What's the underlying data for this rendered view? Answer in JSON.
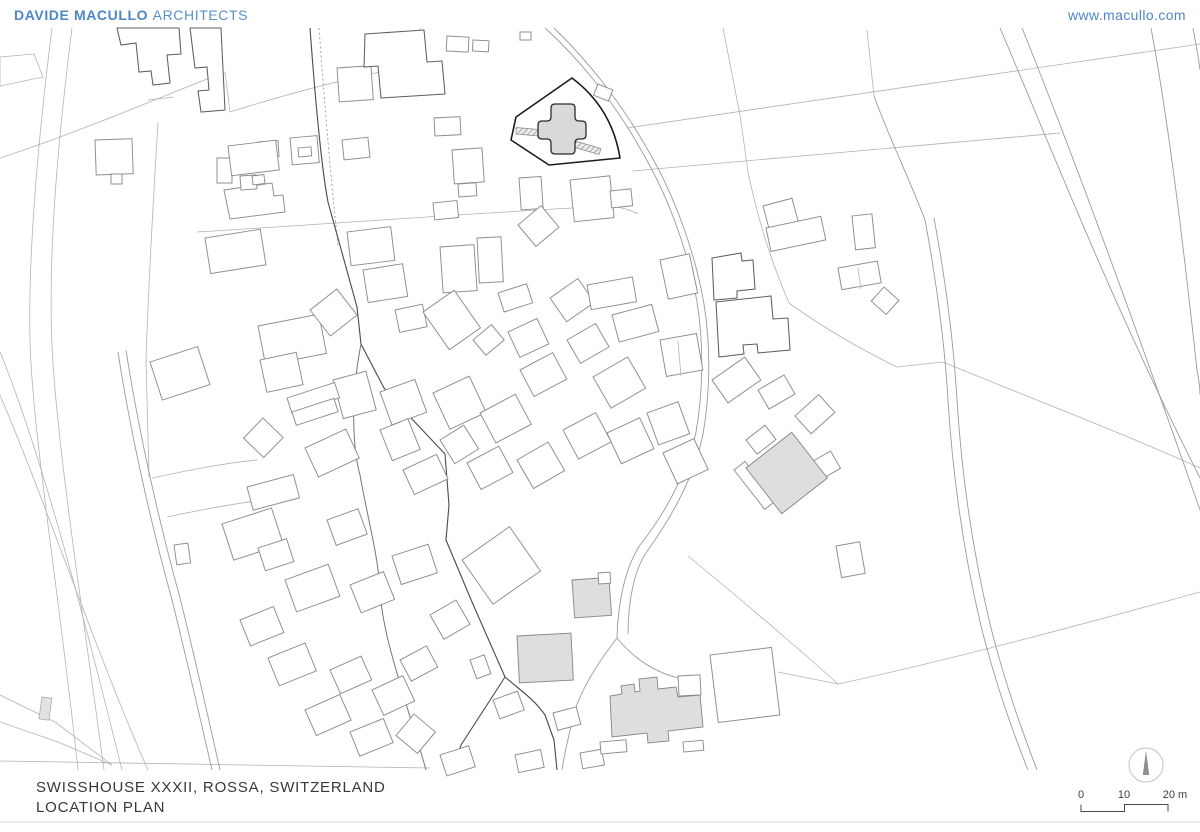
{
  "header": {
    "brand_bold": "DAVIDE MACULLO",
    "brand_light": "ARCHITECTS",
    "website": "www.macullo.com"
  },
  "footer": {
    "project_title": "SWISSHOUSE XXXII, ROSSA, SWITZERLAND",
    "drawing_title": "LOCATION PLAN"
  },
  "scale_bar": {
    "tick_0": "0",
    "tick_10": "10",
    "tick_20": "20 m"
  },
  "icons": {
    "north_arrow": "compass-needle-pointing-up"
  },
  "colors": {
    "accent_blue": "#4d86c6",
    "site_outline": "#1b1b1b",
    "site_building_fill": "#d9d9d9",
    "gray_building_fill": "#dedede",
    "building_stroke": "#8c8c8c",
    "parcel_stroke": "#b3b3b3",
    "title_text": "#383838"
  }
}
